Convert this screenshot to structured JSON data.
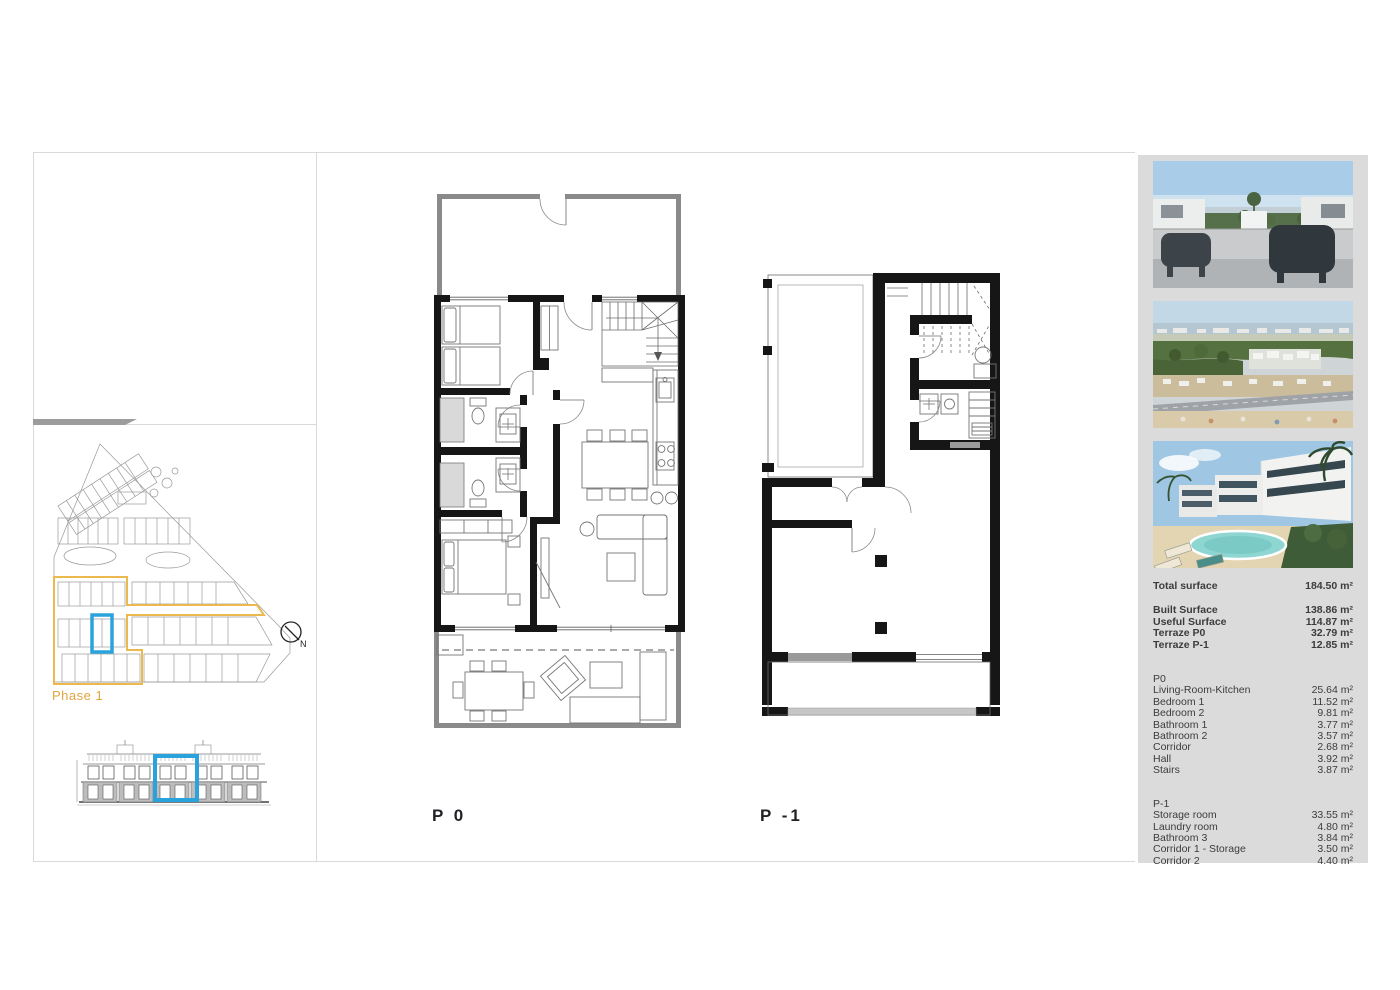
{
  "colors": {
    "accent_blue": "#2aa3dc",
    "phase_yellow": "#ebb94d",
    "phase_text_orange": "#e2a43f",
    "sidebar_bg": "#dbdbdb",
    "wall_black": "#161616",
    "wall_gray": "#8a8a8a"
  },
  "site_plan": {
    "phase_label": "Phase 1",
    "compass_label": "N"
  },
  "floor_plans": {
    "p0_label": "P 0",
    "p1_label": "P -1"
  },
  "sidebar": {
    "photos": [
      {
        "name": "terrace-view-render"
      },
      {
        "name": "aerial-coast-view"
      },
      {
        "name": "residential-pool-render"
      }
    ],
    "summary": {
      "total_label": "Total surface",
      "total_value": "184.50 m²",
      "rows": [
        {
          "label": "Built Surface",
          "value": "138.86 m²"
        },
        {
          "label": "Useful Surface",
          "value": "114.87 m²"
        },
        {
          "label": "Terraze P0",
          "value": "32.79 m²"
        },
        {
          "label": "Terraze P-1",
          "value": "12.85 m²"
        }
      ]
    },
    "p0_title": "P0",
    "p0_rows": [
      {
        "label": "Living-Room-Kitchen",
        "value": "25.64 m²"
      },
      {
        "label": "Bedroom 1",
        "value": "11.52 m²"
      },
      {
        "label": "Bedroom 2",
        "value": "9.81 m²"
      },
      {
        "label": "Bathroom 1",
        "value": "3.77 m²"
      },
      {
        "label": "Bathroom 2",
        "value": "3.57 m²"
      },
      {
        "label": "Corridor",
        "value": "2.68 m²"
      },
      {
        "label": "Hall",
        "value": "3.92 m²"
      },
      {
        "label": "Stairs",
        "value": "3.87 m²"
      }
    ],
    "p1_title": "P-1",
    "p1_rows": [
      {
        "label": "Storage room",
        "value": "33.55 m²"
      },
      {
        "label": "Laundry room",
        "value": "4.80 m²"
      },
      {
        "label": "Bathroom 3",
        "value": "3.84 m²"
      },
      {
        "label": "Corridor 1 - Storage",
        "value": "3.50 m²"
      },
      {
        "label": "Corridor 2",
        "value": "4.40 m²"
      }
    ]
  }
}
